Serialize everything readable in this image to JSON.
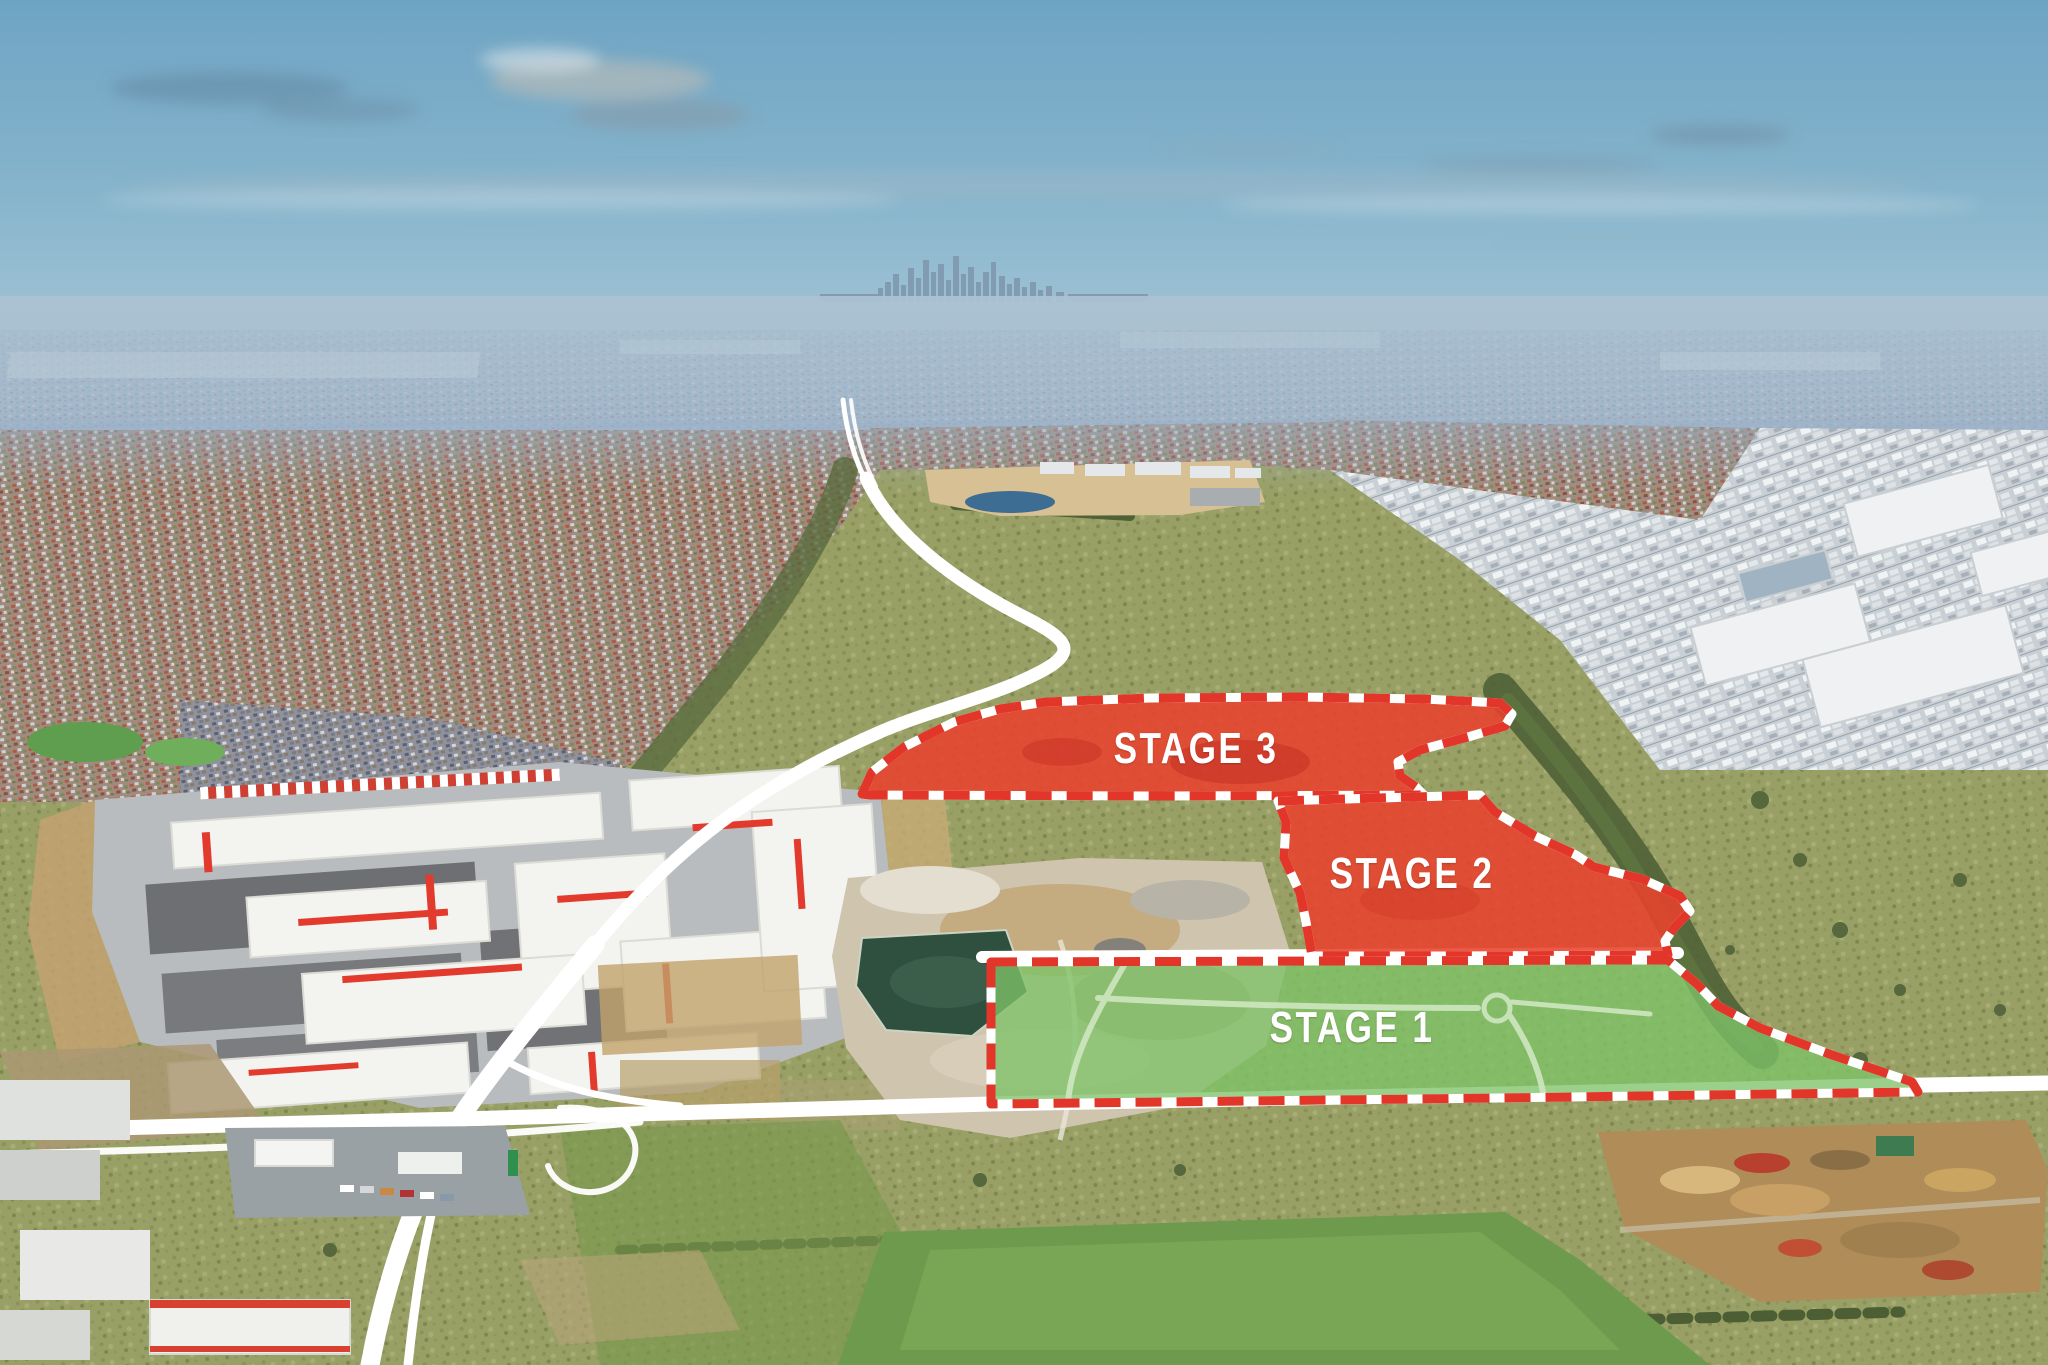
{
  "scene": {
    "stages": [
      {
        "id": "stage-1",
        "label": "STAGE 1",
        "overlay_fill": "#7DC368",
        "label_color": "#FFFFFF"
      },
      {
        "id": "stage-2",
        "label": "STAGE 2",
        "overlay_fill": "#E8422D",
        "label_color": "#FFFFFF"
      },
      {
        "id": "stage-3",
        "label": "STAGE 3",
        "overlay_fill": "#E8422D",
        "label_color": "#FFFFFF"
      }
    ],
    "boundary": {
      "dash_red": "#E2362A",
      "dash_white": "#FFFFFF"
    }
  }
}
